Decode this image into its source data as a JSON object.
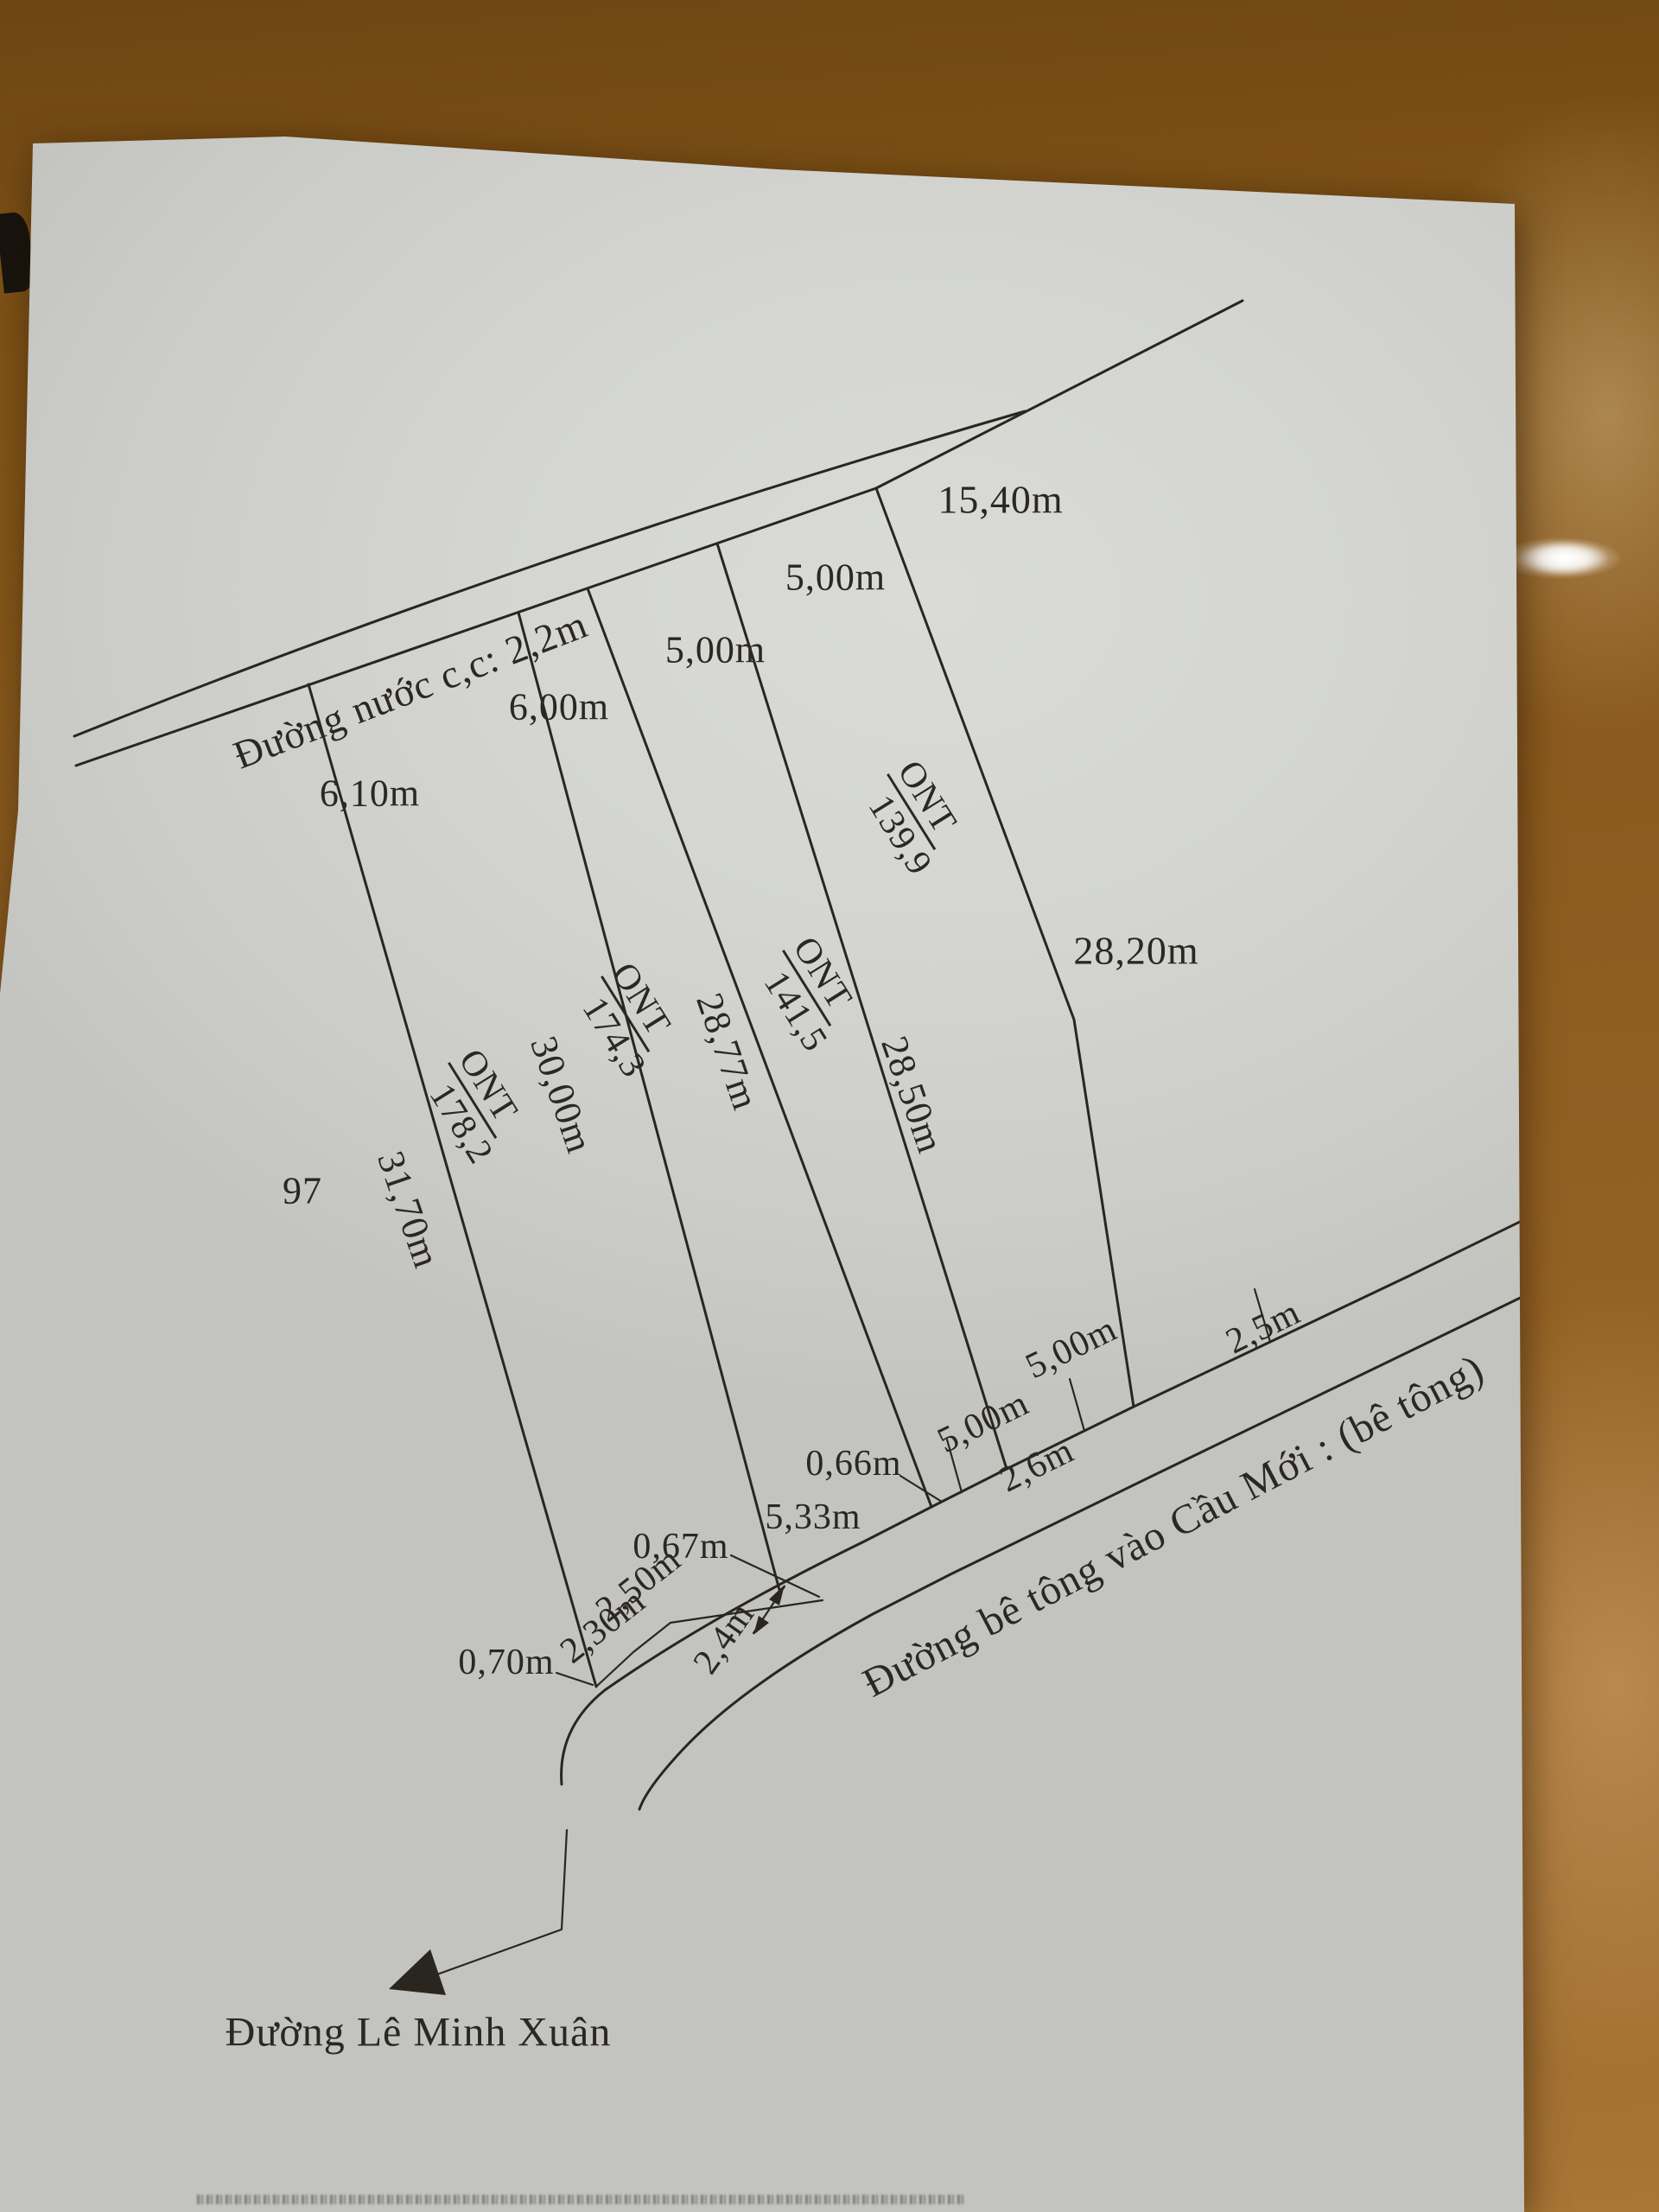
{
  "sheet": {
    "roads": {
      "top": {
        "label": "Đường nước c,c: 2,2m"
      },
      "bottom": {
        "label": "Đường bê tông vào Cầu Mới : (bê tông)"
      },
      "street": {
        "label": "Đường Lê Minh Xuân"
      }
    },
    "adjacent": {
      "plot_number": "97"
    },
    "parcels": [
      {
        "code": "ONT",
        "area": "178,2",
        "side_length": "31,70m"
      },
      {
        "code": "ONT",
        "area": "174,3",
        "side_length": "30,00m"
      },
      {
        "code": "ONT",
        "area": "141,5",
        "side_length": "28,77m"
      },
      {
        "code": "ONT",
        "area": "139,9",
        "side_length": "28,50m"
      }
    ],
    "dimensions": {
      "top": [
        "6,10m",
        "6,00m",
        "5,00m",
        "5,00m"
      ],
      "top_right": "15,40m",
      "right_side": "28,20m",
      "bottom": {
        "d070": "0,70m",
        "d230": "2,30m",
        "d250": "2,50m",
        "d24": "2,4m",
        "d067": "0,67m",
        "d533": "5,33m",
        "d066": "0,66m",
        "d26": "2,6m",
        "d500_left": "5,00m",
        "d500_right": "5,00m",
        "d25": "2,5m"
      }
    }
  }
}
